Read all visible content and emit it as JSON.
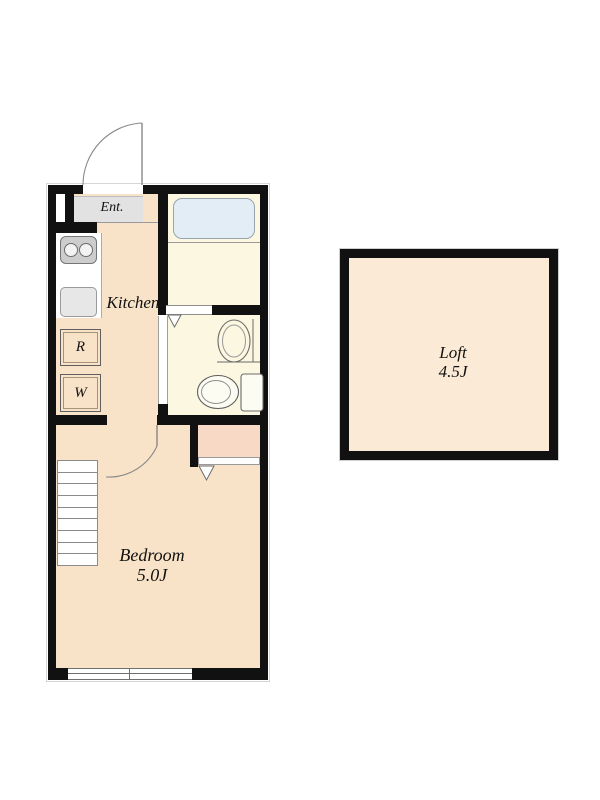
{
  "labels": {
    "entrance": "Ent.",
    "kitchen": "Kitchen",
    "refrigerator": "R",
    "washer": "W",
    "bedroom_name": "Bedroom",
    "bedroom_size": "5.0J",
    "loft_name": "Loft",
    "loft_size": "4.5J"
  },
  "fixtures": [
    "entrance-door",
    "gas-stove",
    "kitchen-sink",
    "refrigerator-space",
    "washer-space",
    "bathtub",
    "bath-folding-door",
    "wash-basin",
    "toilet",
    "sliding-door",
    "bedroom-door",
    "closet",
    "staircase",
    "window"
  ],
  "colors": {
    "wall": "#111111",
    "floor_main": "#f9e3c8",
    "floor_wet": "#fbf7e0",
    "entrance_floor": "#e2e2e2",
    "closet": "#f8d9c6",
    "bathtub": "#e3edf6",
    "loft_floor": "#fbead6",
    "line": "#808080",
    "text": "#111111"
  }
}
